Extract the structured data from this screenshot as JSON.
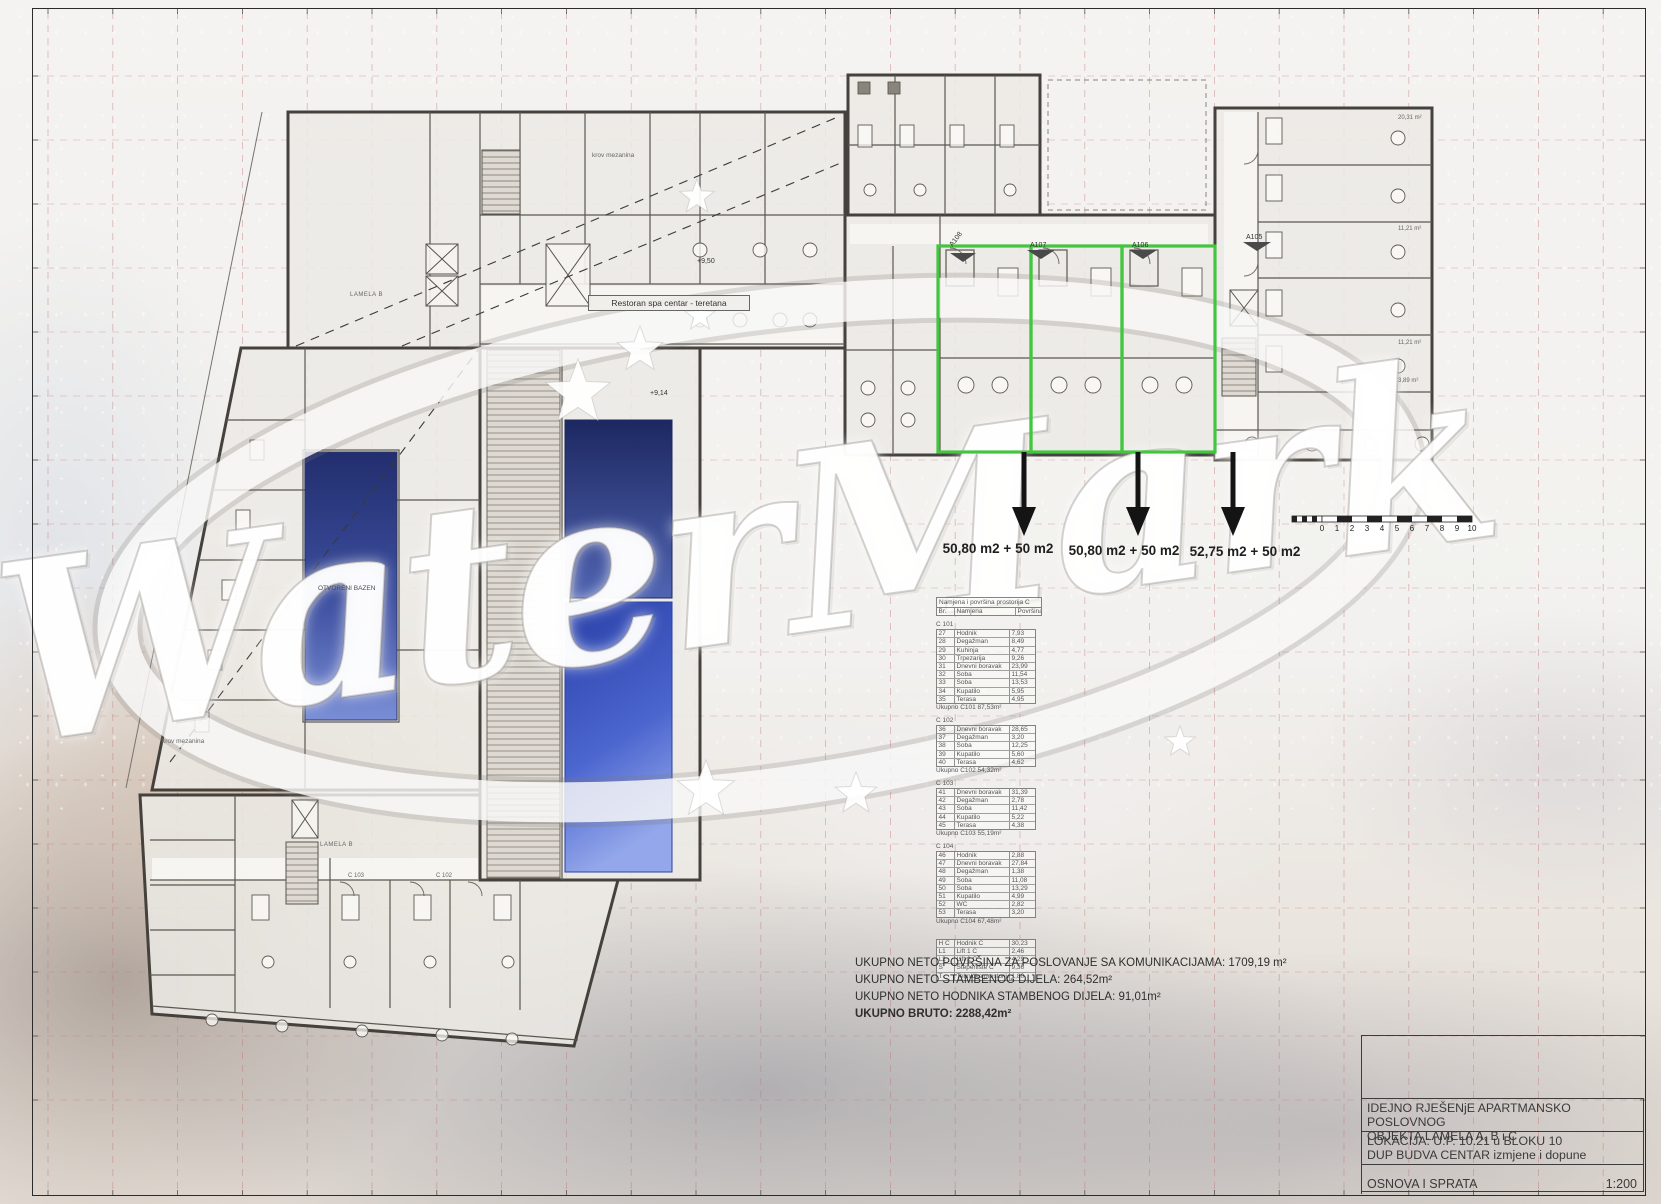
{
  "watermark": {
    "text": "WaterMark"
  },
  "plan": {
    "restoran_label": "Restoran  spa centar - teretana",
    "lamela_label": "LAMELA B",
    "otvoreni_bazen_label": "OTVORENI BAZEN",
    "krov_label": "krov mezanina",
    "level_marker_1": "+9,50",
    "level_marker_2": "+9,14",
    "unit_c103": "C 103",
    "unit_c102": "C 102",
    "right_area_labels": [
      "20,31 m²",
      "11,21 m²",
      "11,21 m²",
      "3,89 m²"
    ],
    "unit_markers": [
      "A108",
      "A107",
      "A106",
      "A105"
    ],
    "area_labels": [
      "50,80 m2 + 50 m2",
      "50,80 m2 + 50 m2",
      "52,75 m2 + 50 m2"
    ],
    "highlight_color": "#43c63f"
  },
  "tables": {
    "header": {
      "title": "Namjena i površina prostorija C",
      "columns": [
        "Br.",
        "Namjena",
        "Površina"
      ]
    },
    "sections": [
      {
        "name": "C 101",
        "rows": [
          [
            "27",
            "Hodnik",
            "7,93"
          ],
          [
            "28",
            "Degažman",
            "8,49"
          ],
          [
            "29",
            "Kuhinja",
            "4,77"
          ],
          [
            "30",
            "Trpezarija",
            "9,26"
          ],
          [
            "31",
            "Dnevni boravak",
            "23,99"
          ],
          [
            "32",
            "Soba",
            "11,54"
          ],
          [
            "33",
            "Soba",
            "13,53"
          ],
          [
            "34",
            "Kupatilo",
            "5,95"
          ],
          [
            "35",
            "Terasa",
            "4,95"
          ]
        ],
        "total": "Ukupno C101 87,53m²",
        "gap": false
      },
      {
        "name": "C 102",
        "rows": [
          [
            "36",
            "Dnevni boravak",
            "28,65"
          ],
          [
            "37",
            "Degažman",
            "3,20"
          ],
          [
            "38",
            "Soba",
            "12,25"
          ],
          [
            "39",
            "Kupatilo",
            "5,60"
          ],
          [
            "40",
            "Terasa",
            "4,62"
          ]
        ],
        "total": "Ukupno C102 54,32m²",
        "gap": false
      },
      {
        "name": "C 103",
        "rows": [
          [
            "41",
            "Dnevni boravak",
            "31,39"
          ],
          [
            "42",
            "Degažman",
            "2,78"
          ],
          [
            "43",
            "Soba",
            "11,42"
          ],
          [
            "44",
            "Kupatilo",
            "5,22"
          ],
          [
            "45",
            "Terasa",
            "4,38"
          ]
        ],
        "total": "Ukupno C103 55,19m²",
        "gap": false
      },
      {
        "name": "C 104",
        "rows": [
          [
            "46",
            "Hodnik",
            "2,88"
          ],
          [
            "47",
            "Dnevni boravak",
            "27,84"
          ],
          [
            "48",
            "Degažman",
            "1,38"
          ],
          [
            "49",
            "Soba",
            "11,08"
          ],
          [
            "50",
            "Soba",
            "13,29"
          ],
          [
            "51",
            "Kupatilo",
            "4,99"
          ],
          [
            "52",
            "WC",
            "2,82"
          ],
          [
            "53",
            "Terasa",
            "3,20"
          ]
        ],
        "total": "Ukupno C104 67,48m²",
        "gap": false
      },
      {
        "name": "",
        "rows": [
          [
            "H C",
            "Hodnik C",
            "30,23"
          ],
          [
            "L1",
            "Lift 1 C",
            "2,46"
          ],
          [
            "L2",
            "Lift 2 C",
            "4,29"
          ],
          [
            "S",
            "Stepenište C",
            "9,36"
          ],
          [
            "T",
            "Tehnička prostorija C",
            "1,80"
          ]
        ],
        "total": "",
        "gap": true
      }
    ]
  },
  "totals": {
    "line1": "UKUPNO NETO POVRŠINA ZA POSLOVANJE SA KOMUNIKACIJAMA: 1709,19 m²",
    "line2": "UKUPNO NETO STAMBENOG DIJELA: 264,52m²",
    "line3": "UKUPNO NETO HODNIKA STAMBENOG DIJELA: 91,01m²",
    "line4": "UKUPNO BRUTO: 2288,42m²"
  },
  "title_block": {
    "project_line1": "IDEJNO RJEŠENjE APARTMANSKO POSLOVNOG",
    "project_line2": "OBJEKTA LAMELA A, B i C",
    "location_line1": "LOKACIJA: U.P. 10.21 u BLOKU 10",
    "location_line2": "DUP BUDVA CENTAR izmjene i dopune",
    "drawing_name": "OSNOVA I SPRATA",
    "scale": "1:200"
  },
  "scale_bar": {
    "numbers": [
      "0",
      "1",
      "2",
      "3",
      "4",
      "5",
      "6",
      "7",
      "8",
      "9",
      "10"
    ]
  }
}
